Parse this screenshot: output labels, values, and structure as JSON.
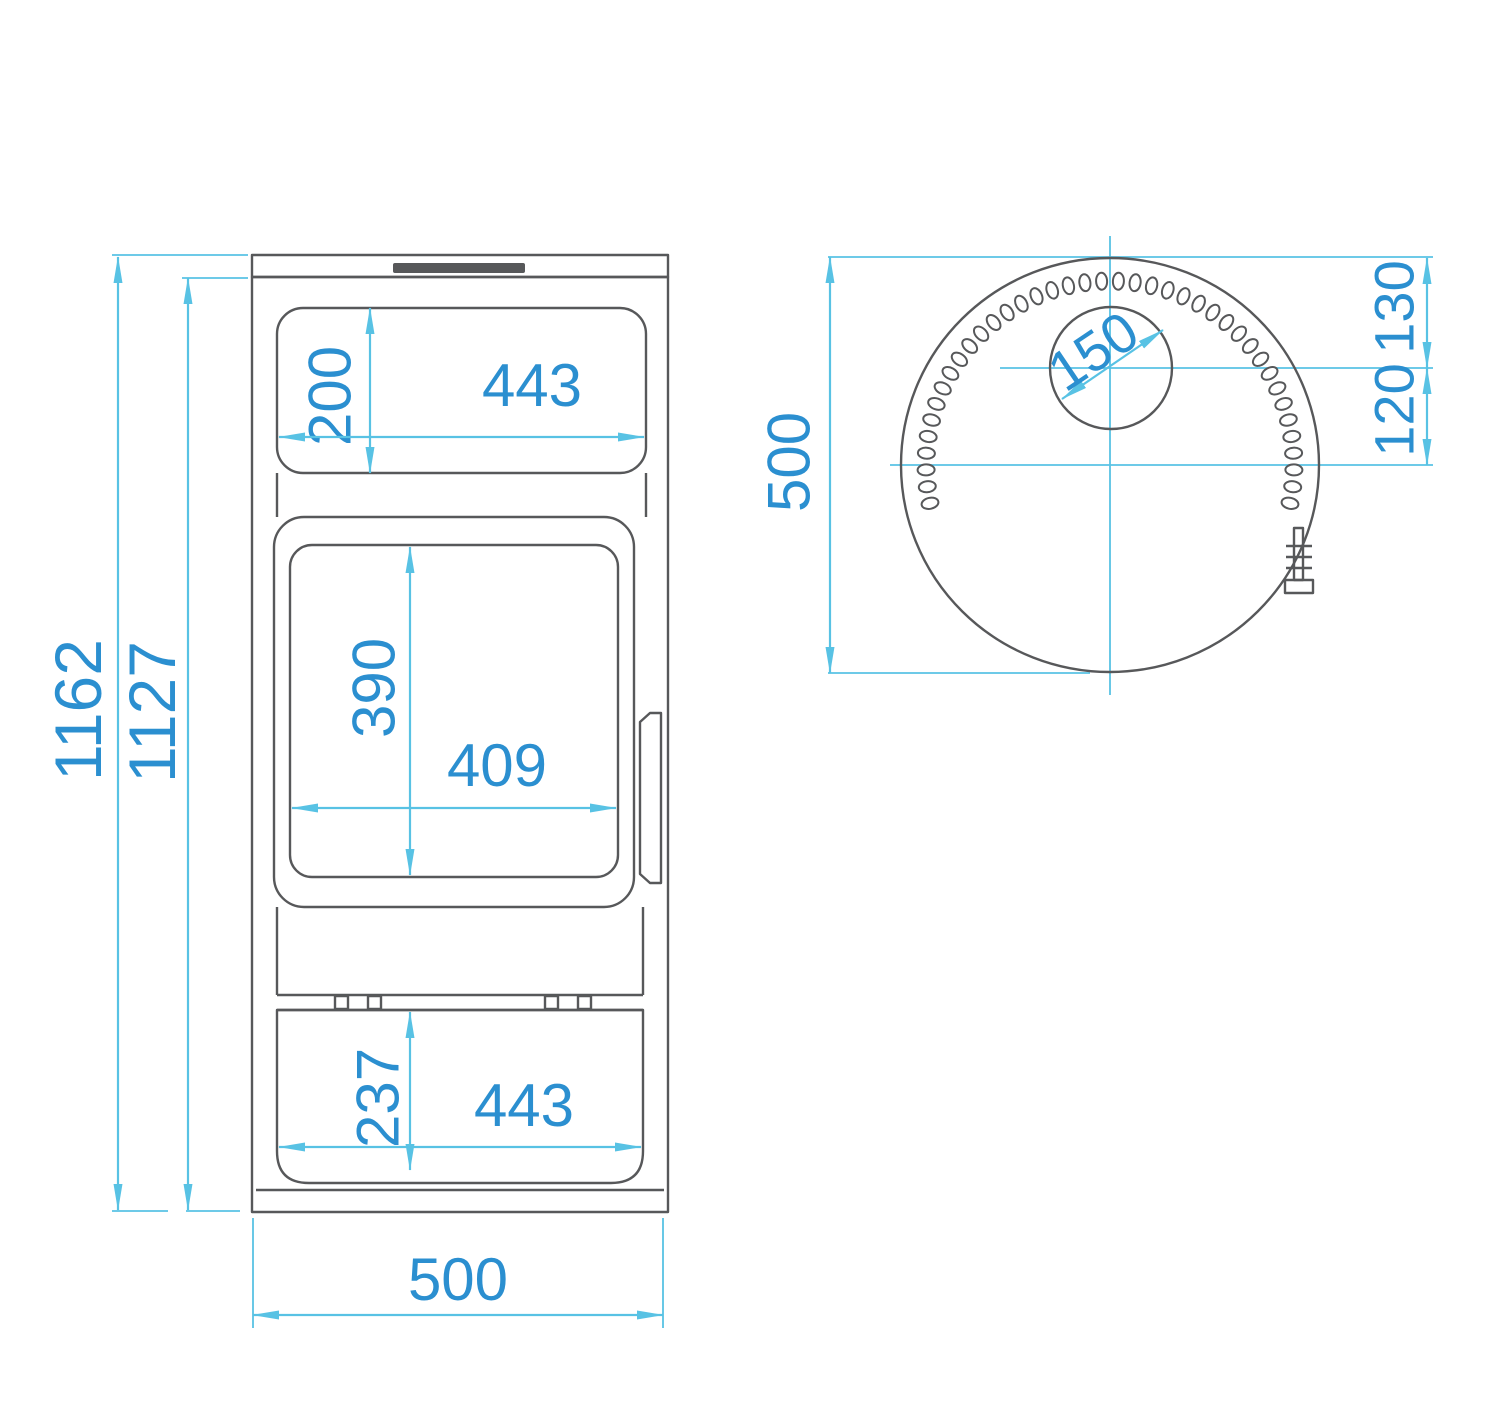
{
  "front_view": {
    "overall_height_mm": "1162",
    "body_height_mm": "1127",
    "overall_width_mm": "500",
    "top_window": {
      "height_mm": "200",
      "width_mm": "443"
    },
    "door_window": {
      "height_mm": "390",
      "width_mm": "409"
    },
    "ash_drawer": {
      "height_mm": "237",
      "width_mm": "443"
    }
  },
  "top_view": {
    "body_diameter_mm": "500",
    "flue_diameter_mm": "150",
    "flue_center_to_body_center_mm": "120",
    "flue_center_to_front_edge_mm": "130"
  },
  "colors": {
    "drawing_line": "#57585a",
    "dimension_line": "#58c2e4",
    "dimension_text": "#2b8fd0"
  }
}
